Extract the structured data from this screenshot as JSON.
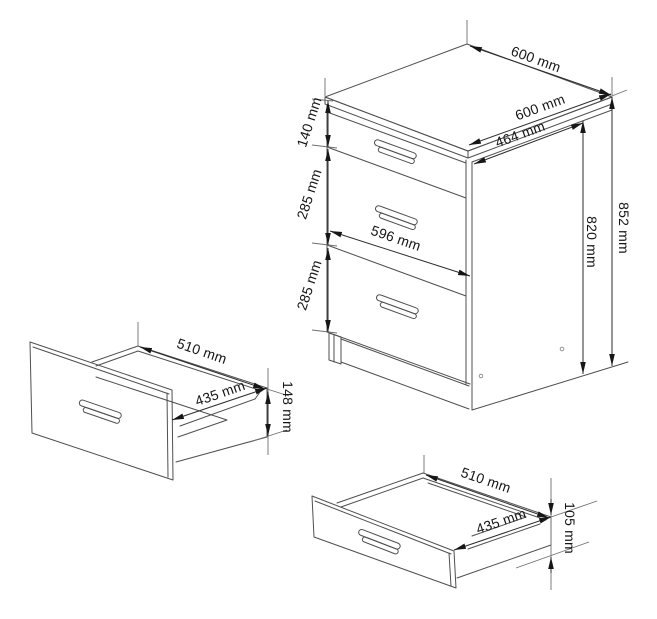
{
  "drawing": {
    "unit": "mm",
    "background_color": "#ffffff",
    "line_color": "#4f4f4f",
    "dimension_line_color": "#2d2d2d",
    "text_color": "#161616",
    "cabinet": {
      "top_depth": "600 mm",
      "top_width": "600 mm",
      "side_inner_depth": "464 mm",
      "drawer_front_width": "596 mm",
      "drawer1_front_height": "140 mm",
      "drawer2_front_height": "285 mm",
      "drawer3_front_height": "285 mm",
      "carcass_height": "820 mm",
      "total_height": "852 mm"
    },
    "drawer_large": {
      "depth": "510 mm",
      "inner_width": "435 mm",
      "front_height": "148 mm"
    },
    "drawer_small": {
      "depth": "510 mm",
      "inner_width": "435 mm",
      "front_height": "105 mm"
    }
  }
}
